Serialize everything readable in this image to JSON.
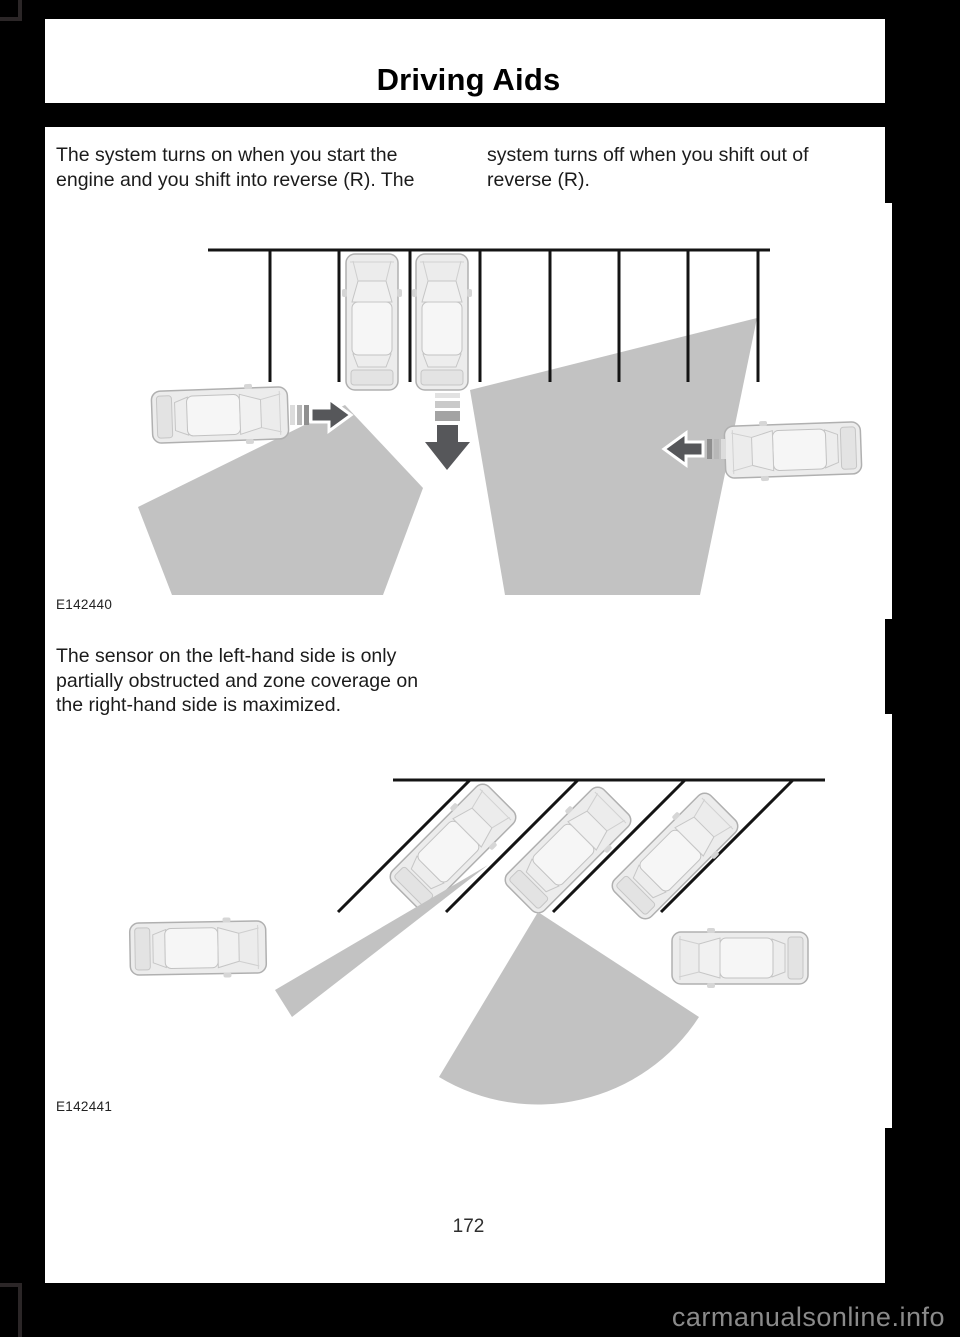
{
  "header": {
    "title": "Driving Aids"
  },
  "intro": {
    "col1": [
      "The system turns on when you start the",
      "engine and you shift into reverse (R). The"
    ],
    "col2": [
      "system turns off when you shift out of",
      "reverse (R)."
    ]
  },
  "figure1": {
    "label": "E142440"
  },
  "note": {
    "lines": [
      "The sensor on the left-hand side is only",
      "partially obstructed and zone coverage on",
      "the right-hand side is maximized."
    ]
  },
  "figure2": {
    "label": "E142441"
  },
  "footer": {
    "page_number": "172",
    "watermark": "carmanualsonline.info"
  },
  "icons": {
    "car_top_view": "svg-rounded-rect-vehicle",
    "sensor_zone": "gray-polygon",
    "traffic_arrow": "dark-outlined-arrow"
  },
  "colors": {
    "sensor_zone": "#c2c2c2",
    "arrow_dark": "#56575a",
    "page_background": "#ffffff",
    "frame_background": "#000000",
    "corner_bracket": "#2b2627",
    "watermark_text": "#8a8a8a"
  }
}
